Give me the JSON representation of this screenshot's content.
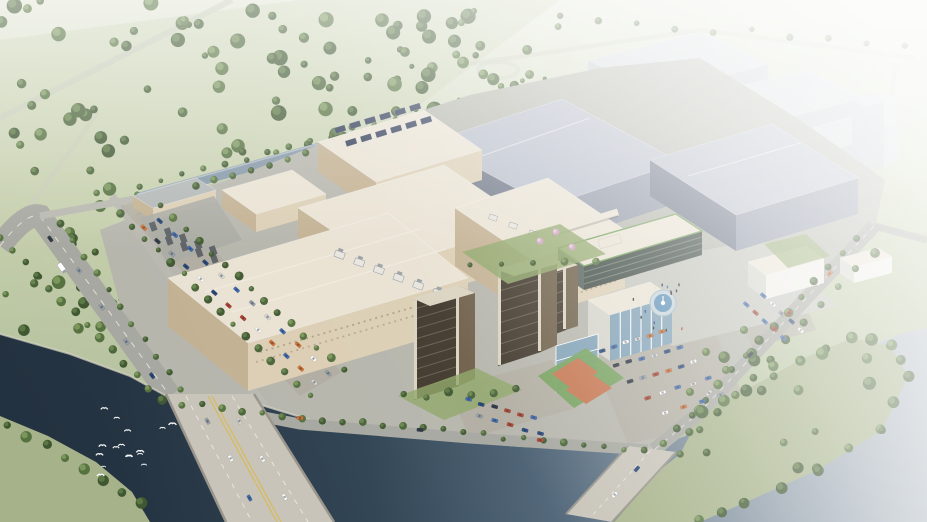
{
  "meta": {
    "title": "Aerial architectural rendering of a riverside industrial campus",
    "media_type": "3d-architectural-rendering",
    "view": "oblique aerial view looking across a river toward the campus",
    "atmosphere": "hazy daylight, scene fades to white toward the upper-right horizon"
  },
  "palette": {
    "bg_top": "#e2e6d6",
    "bg_mid": "#c3cdaa",
    "bg_bottom": "#a9b795",
    "water_dark": "#233240",
    "water_deep": "#2d4151",
    "water_mid": "#51677a",
    "water_pale": "#8b99a6",
    "water_haze": "#b3bcc4",
    "canal": "#8496a6",
    "road": "#a6a7a0",
    "road_light": "#b8b8b0",
    "road_faint": "#c6cbb7",
    "road_line": "#ece9de",
    "road_yellow": "#d8b950",
    "bridge_deck": "#c7c3b8",
    "bridge_edge": "#98948a",
    "ground": "#b5b5ac",
    "plaza": "#c3c3bb",
    "lot": "#b0aba0",
    "beige_roof": "#e9e2d3",
    "beige_wall_light": "#dbceb4",
    "beige_wall_dark": "#c2b091",
    "beige_detail": "#8f7f63",
    "gray_roof": "#b6bcc8",
    "gray_wall": "#6e7686",
    "gray_wall_light": "#8f97a6",
    "distant_roof": "#d3d7de",
    "distant_wall": "#c0c6d0",
    "tower_dark": "#41382c",
    "tower_side": "#6e5f49",
    "tower_cream": "#dbd3c0",
    "glass_dark": "#404b44",
    "glass_blue": "#7fa0b4",
    "white_wall": "#eeede7",
    "white_shade": "#d3d3ca",
    "court_orange": "#c4754f",
    "court_green": "#74a05c",
    "fountain_ring": "#c5d4da",
    "fountain_water": "#5d90b6",
    "solar": "#2f3a56",
    "equip_white": "#e7e5de",
    "equip_gray": "#9aa0a5",
    "sub_dark": "#5c6166",
    "lawn": "#8fa668",
    "park_grass": "#a6b289",
    "bird": "#ffffff"
  },
  "scene": {
    "background": {
      "label": "forest and open fields crossed by faint country roads"
    },
    "distant_city": {
      "label": "faded warehouse blocks and a tower on the hazy horizon"
    },
    "canal": {
      "label": "tree-lined canal along the north-west edge of the campus"
    },
    "campus": {
      "label": "industrial campus",
      "buildings": [
        {
          "id": "main-factory",
          "label": "large beige production hall",
          "palette_key": "beige_roof"
        },
        {
          "id": "factory-hall-2",
          "label": "beige hall with rooftop cooling plant",
          "palette_key": "beige_roof"
        },
        {
          "id": "solar-hall",
          "label": "beige hall with rooftop solar array",
          "palette_key": "solar"
        },
        {
          "id": "tall-plant-block",
          "label": "tall beige utility block",
          "palette_key": "beige_wall_light"
        },
        {
          "id": "warehouse-1",
          "label": "gray warehouse hall",
          "palette_key": "gray_roof"
        },
        {
          "id": "warehouse-2",
          "label": "gray warehouse hall",
          "palette_key": "gray_roof"
        },
        {
          "id": "office-slab",
          "label": "office slab with green roof edge and dark glass",
          "palette_key": "glass_dark"
        },
        {
          "id": "dorm-tower-1",
          "label": "bronze residential tower",
          "palette_key": "tower_dark"
        },
        {
          "id": "dorm-tower-2",
          "label": "bronze residential tower",
          "palette_key": "tower_dark"
        },
        {
          "id": "culture-cube",
          "label": "white cultural building with louvered glass",
          "palette_key": "white_wall"
        },
        {
          "id": "plaza-pavilion",
          "label": "white pavilion beside the plaza",
          "palette_key": "white_wall"
        },
        {
          "id": "gatehouse",
          "label": "utility shed and electrical substation",
          "palette_key": "sub_dark"
        }
      ],
      "amenities": [
        "circular fountain plaza",
        "2 basketball courts",
        "surface parking lots",
        "rooftop solar array",
        "rooftop cooling plant",
        "electrical substation"
      ]
    },
    "river": {
      "label": "dark river in the foreground",
      "bird_count": 16
    },
    "bridges": [
      {
        "id": "main-bridge",
        "label": "multi-lane river bridge with yellow median and traffic"
      },
      {
        "id": "secondary-bridge",
        "label": "smaller bridge at the south-east corner"
      }
    ],
    "roads": {
      "label": "tree-lined arterial roads with moving traffic"
    },
    "park": {
      "label": "wooded park peninsula surrounded by hazy water"
    },
    "vehicles": {
      "car_colors": [
        "#ffffff",
        "#3f6cb4",
        "#b6432e",
        "#d96f2e",
        "#2f3744",
        "#97a2ad",
        "#27497f",
        "#d9d9d6"
      ],
      "includes": [
        "cars",
        "white truck"
      ]
    },
    "vegetation": {
      "tree_pairs": [
        [
          "#3f5731",
          "#5d7a45"
        ],
        [
          "#4a6339",
          "#6b8850"
        ],
        [
          "#55713f",
          "#7e9a5e"
        ]
      ],
      "blossom": "#cfa3bf"
    }
  }
}
